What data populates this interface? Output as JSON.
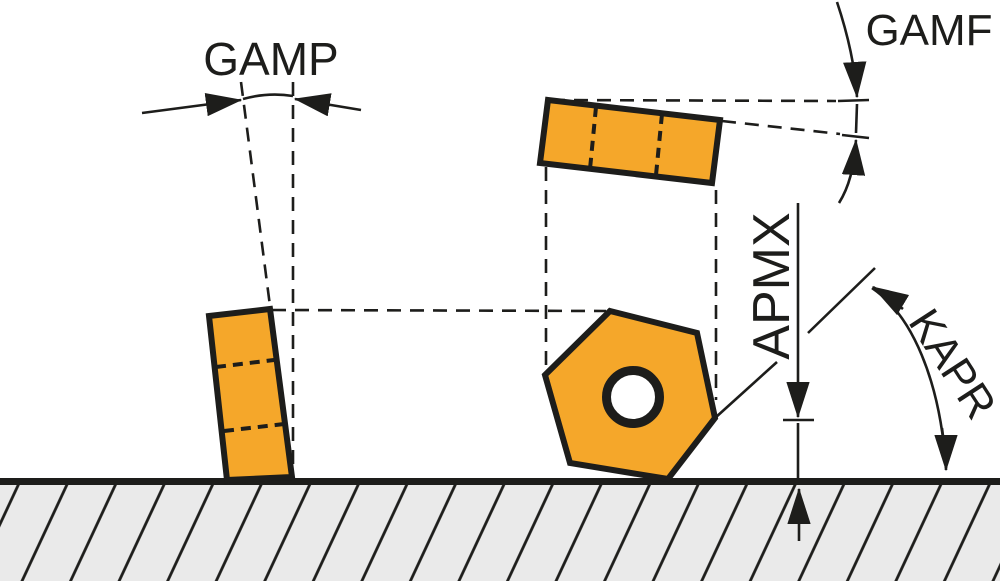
{
  "diagram": {
    "type": "cutting-tool-insert-geometry-diagram",
    "labels": {
      "gamp": "GAMP",
      "gamf": "GAMF",
      "apmx": "APMX",
      "kapr": "KAPR"
    },
    "colors": {
      "insert": "#F5A72A",
      "line": "#1D1D1B",
      "ground": "#EAEAEA",
      "background": "#FFFFFF"
    }
  }
}
